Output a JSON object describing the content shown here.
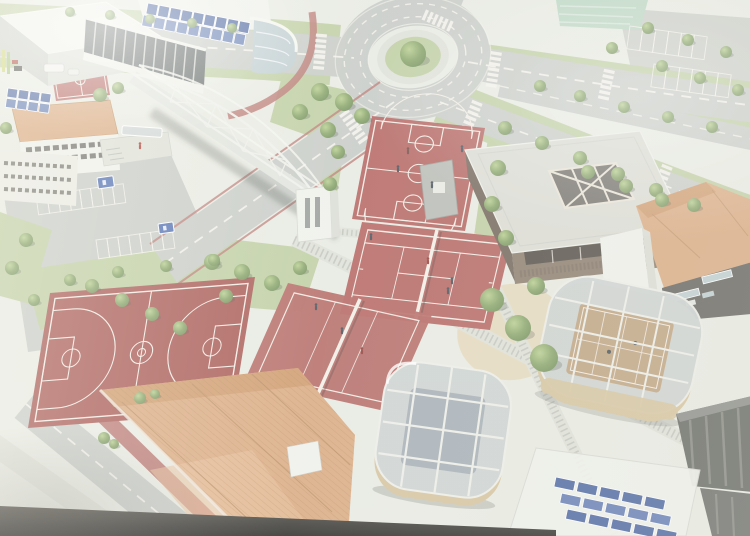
{
  "meta": {
    "alt": "Aerial 3D architectural rendering of a school sports campus: red basketball, tennis and volleyball courts, a white pedestrian truss bridge over a road, a tree-lined roundabout, a gymnasium, glass-roofed pavilions, terracotta-roofed buildings and rooftop solar panels"
  },
  "colors": {
    "bg": "#e7ebe0",
    "road": "#c6cbc4",
    "road_dark": "#b9bfb8",
    "road_line": "#f4f2ea",
    "kerb_red": "#c4726b",
    "court_red": "#c2625c",
    "court_red_dark": "#b5554f",
    "court_line": "#f3ece2",
    "grass": "#bccf99",
    "grass_dark": "#a8bf85",
    "tree": "#85a75f",
    "tree_light": "#b4d083",
    "tree_dark": "#6d9150",
    "field_teal": "#b7d8c0",
    "white_build": "#eff1e9",
    "build_shade": "#d9ddd3",
    "build_shade2": "#c9cec5",
    "glass_dark": "#5c6562",
    "glass_blue": "#bccdd2",
    "solar_blue": "#4565ae",
    "solar_blue2": "#5d7cc0",
    "roof_orange": "#e3a876",
    "roof_orange_dark": "#d6985f",
    "roof_orange_light": "#edbd8d",
    "gym_roof": "#dadcd2",
    "gym_wall": "#8d7c69",
    "gym_wall_dark": "#746556",
    "win_dark": "#4a473f",
    "pav_wall": "#d8c394",
    "pav_glass": "#a3aeb6",
    "pav_glass_light": "#ccd3d1",
    "pav_mullion": "#eceee6",
    "pav_court": "#c3a277",
    "sand": "#e6d8b4",
    "walk": "#dde1d6",
    "walk_tick": "#b6bbb0",
    "dark_build": "#63665f",
    "dark_build_light": "#8b8e85",
    "sign_blue": "#4a6fc2",
    "strip_dark1": "#56544b",
    "strip_dark2": "#2b2a26"
  },
  "scene": {
    "elements": [
      "roundabout",
      "pedestrian-truss-bridge",
      "basketball-court-top",
      "basketball-court-left",
      "tennis-court-center",
      "volleyball-court-center",
      "mini-court-corner",
      "sports-hall-solar-roof",
      "arena-building",
      "classroom-buildings",
      "gymnasium",
      "glass-roof-pavilion-bottom",
      "glass-roof-pavilion-right",
      "terracotta-roof-building-bottom",
      "terracotta-roof-building-right",
      "dark-service-building",
      "rooftop-solar-array",
      "parking-lot-left",
      "parking-lot-top-right",
      "playing-field",
      "sand-garden-with-trees",
      "textured-walkways",
      "roads-and-crosswalks"
    ],
    "trees": [
      [
        413,
        54,
        13
      ],
      [
        70,
        12,
        5
      ],
      [
        110,
        15,
        5
      ],
      [
        150,
        19,
        5
      ],
      [
        192,
        23,
        5
      ],
      [
        232,
        28,
        5
      ],
      [
        320,
        92,
        9
      ],
      [
        344,
        102,
        9
      ],
      [
        300,
        112,
        8
      ],
      [
        362,
        116,
        8
      ],
      [
        328,
        130,
        8
      ],
      [
        338,
        152,
        7
      ],
      [
        330,
        184,
        7
      ],
      [
        498,
        168,
        8
      ],
      [
        492,
        204,
        8
      ],
      [
        506,
        238,
        8
      ],
      [
        212,
        262,
        8
      ],
      [
        242,
        272,
        8
      ],
      [
        272,
        283,
        8
      ],
      [
        300,
        268,
        7
      ],
      [
        226,
        296,
        7
      ],
      [
        540,
        86,
        6
      ],
      [
        580,
        96,
        6
      ],
      [
        624,
        107,
        6
      ],
      [
        668,
        117,
        6
      ],
      [
        712,
        127,
        6
      ],
      [
        505,
        128,
        7
      ],
      [
        542,
        143,
        7
      ],
      [
        580,
        158,
        7
      ],
      [
        618,
        174,
        7
      ],
      [
        656,
        190,
        7
      ],
      [
        694,
        205,
        7
      ],
      [
        588,
        172,
        7
      ],
      [
        626,
        186,
        7
      ],
      [
        662,
        200,
        7
      ],
      [
        648,
        28,
        6
      ],
      [
        688,
        40,
        6
      ],
      [
        726,
        52,
        6
      ],
      [
        662,
        66,
        6
      ],
      [
        700,
        78,
        6
      ],
      [
        738,
        90,
        6
      ],
      [
        612,
        48,
        6
      ],
      [
        492,
        300,
        12
      ],
      [
        518,
        328,
        13
      ],
      [
        544,
        358,
        14
      ],
      [
        70,
        280,
        6
      ],
      [
        118,
        272,
        6
      ],
      [
        166,
        266,
        6
      ],
      [
        214,
        260,
        6
      ],
      [
        26,
        240,
        7
      ],
      [
        12,
        268,
        7
      ],
      [
        34,
        300,
        6
      ],
      [
        92,
        286,
        7
      ],
      [
        122,
        300,
        7
      ],
      [
        152,
        314,
        7
      ],
      [
        180,
        328,
        7
      ],
      [
        100,
        95,
        7
      ],
      [
        118,
        88,
        6
      ],
      [
        140,
        398,
        6
      ],
      [
        155,
        394,
        5
      ],
      [
        104,
        438,
        6
      ],
      [
        114,
        444,
        5
      ],
      [
        536,
        286,
        9
      ],
      [
        6,
        128,
        6
      ]
    ],
    "people": [
      [
        408,
        152,
        "#7a4a42"
      ],
      [
        432,
        186,
        "#44505a"
      ],
      [
        398,
        170,
        "#44505a"
      ],
      [
        462,
        150,
        "#44505a"
      ],
      [
        428,
        262,
        "#a03a33"
      ],
      [
        448,
        292,
        "#44505a"
      ],
      [
        342,
        332,
        "#44505a"
      ],
      [
        362,
        352,
        "#a03a33"
      ],
      [
        316,
        308,
        "#44505a"
      ],
      [
        140,
        147,
        "#c23b30"
      ],
      [
        452,
        282,
        "#44505a"
      ],
      [
        371,
        238,
        "#44505a"
      ]
    ],
    "crosswalks": [
      [
        322,
        34,
        95,
        7
      ],
      [
        424,
        14,
        24,
        6
      ],
      [
        497,
        52,
        99,
        7
      ],
      [
        478,
        102,
        112,
        6
      ],
      [
        344,
        112,
        55,
        7
      ],
      [
        610,
        70,
        102,
        6
      ],
      [
        668,
        166,
        112,
        6
      ]
    ],
    "stall_rows": [
      [
        36,
        196,
        -8,
        8,
        11,
        19
      ],
      [
        96,
        240,
        -8,
        7,
        11,
        19
      ],
      [
        630,
        26,
        8,
        6,
        13,
        23
      ],
      [
        654,
        64,
        8,
        6,
        13,
        23
      ]
    ],
    "solar_arrays": [
      {
        "x": 148,
        "y": 3,
        "angle": 11,
        "rows": 2,
        "cols": 9,
        "w": 10.5,
        "h": 11,
        "gx": 1.2,
        "gy": 1.5,
        "shift": -2
      },
      {
        "x": 8,
        "y": 88,
        "angle": 8,
        "rows": 2,
        "cols": 4,
        "w": 10,
        "h": 9,
        "gx": 1.2,
        "gy": 1.4,
        "shift": 0
      },
      {
        "x": 556,
        "y": 477,
        "angle": 12,
        "rows": 3,
        "cols": 5,
        "w": 20,
        "h": 10,
        "gx": 3,
        "gy": 4.5,
        "shift": 9
      }
    ],
    "signs": [
      [
        97,
        178,
        16,
        11,
        -8
      ],
      [
        158,
        224,
        15,
        10,
        -8
      ],
      [
        2,
        158,
        11,
        9,
        -8
      ]
    ]
  }
}
